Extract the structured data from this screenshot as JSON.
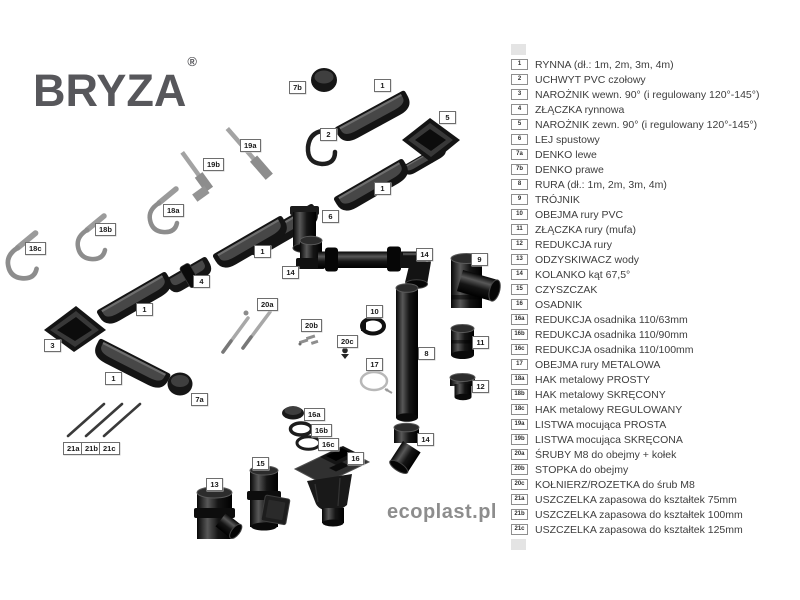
{
  "brand": {
    "name": "BRYZA",
    "registered_mark": "®"
  },
  "footer": {
    "website": "ecoplast.pl"
  },
  "colors": {
    "part_dark": "#141414",
    "metal_gray": "#9b9b9b",
    "logo_gray": "#57575b",
    "footer_gray": "#8d8d8d",
    "label_border": "#6e6e6e",
    "legend_text": "#3d3d3d"
  },
  "legend": {
    "items": [
      {
        "id": "1",
        "label": "RYNNA (dł.: 1m, 2m, 3m, 4m)"
      },
      {
        "id": "2",
        "label": "UCHWYT PVC czołowy"
      },
      {
        "id": "3",
        "label": "NAROŻNIK wewn. 90° (i regulowany 120°-145°)"
      },
      {
        "id": "4",
        "label": "ZŁĄCZKA rynnowa"
      },
      {
        "id": "5",
        "label": "NAROŻNIK zewn. 90° (i regulowany 120°-145°)"
      },
      {
        "id": "6",
        "label": "LEJ spustowy"
      },
      {
        "id": "7a",
        "label": "DENKO lewe"
      },
      {
        "id": "7b",
        "label": "DENKO prawe"
      },
      {
        "id": "8",
        "label": "RURA (dł.: 1m, 2m, 3m, 4m)"
      },
      {
        "id": "9",
        "label": "TRÓJNIK"
      },
      {
        "id": "10",
        "label": "OBEJMA rury PVC"
      },
      {
        "id": "11",
        "label": "ZŁĄCZKA rury (mufa)"
      },
      {
        "id": "12",
        "label": "REDUKCJA rury"
      },
      {
        "id": "13",
        "label": "ODZYSKIWACZ wody"
      },
      {
        "id": "14",
        "label": "KOLANKO kąt 67,5°"
      },
      {
        "id": "15",
        "label": "CZYSZCZAK"
      },
      {
        "id": "16",
        "label": "OSADNIK"
      },
      {
        "id": "16a",
        "label": "REDUKCJA osadnika 110/63mm"
      },
      {
        "id": "16b",
        "label": "REDUKCJA osadnika 110/90mm"
      },
      {
        "id": "16c",
        "label": "REDUKCJA osadnika 110/100mm"
      },
      {
        "id": "17",
        "label": "OBEJMA rury METALOWA"
      },
      {
        "id": "18a",
        "label": "HAK metalowy PROSTY"
      },
      {
        "id": "18b",
        "label": "HAK metalowy SKRĘCONY"
      },
      {
        "id": "18c",
        "label": "HAK metalowy REGULOWANY"
      },
      {
        "id": "19a",
        "label": "LISTWA mocująca PROSTA"
      },
      {
        "id": "19b",
        "label": "LISTWA mocująca SKRĘCONA"
      },
      {
        "id": "20a",
        "label": "ŚRUBY M8 do obejmy + kołek"
      },
      {
        "id": "20b",
        "label": "STOPKA do obejmy"
      },
      {
        "id": "20c",
        "label": "KOŁNIERZ/ROZETKA do śrub M8"
      },
      {
        "id": "21a",
        "label": "USZCZELKA zapasowa do kształtek 75mm"
      },
      {
        "id": "21b",
        "label": "USZCZELKA zapasowa do kształtek 100mm"
      },
      {
        "id": "21c",
        "label": "USZCZELKA zapasowa do kształtek 125mm"
      }
    ]
  },
  "diagram": {
    "part_labels": [
      {
        "id": "7b",
        "x": 289,
        "y": 81
      },
      {
        "id": "1",
        "x": 374,
        "y": 79
      },
      {
        "id": "5",
        "x": 439,
        "y": 111
      },
      {
        "id": "2",
        "x": 320,
        "y": 128
      },
      {
        "id": "19a",
        "x": 240,
        "y": 139
      },
      {
        "id": "19b",
        "x": 203,
        "y": 158
      },
      {
        "id": "1",
        "x": 374,
        "y": 182
      },
      {
        "id": "18a",
        "x": 163,
        "y": 204
      },
      {
        "id": "6",
        "x": 322,
        "y": 210
      },
      {
        "id": "18b",
        "x": 95,
        "y": 223
      },
      {
        "id": "18c",
        "x": 25,
        "y": 242
      },
      {
        "id": "1",
        "x": 254,
        "y": 245
      },
      {
        "id": "14",
        "x": 282,
        "y": 266
      },
      {
        "id": "14",
        "x": 416,
        "y": 248
      },
      {
        "id": "9",
        "x": 471,
        "y": 253
      },
      {
        "id": "4",
        "x": 193,
        "y": 275
      },
      {
        "id": "20a",
        "x": 257,
        "y": 298
      },
      {
        "id": "1",
        "x": 136,
        "y": 303
      },
      {
        "id": "10",
        "x": 366,
        "y": 305
      },
      {
        "id": "20b",
        "x": 301,
        "y": 319
      },
      {
        "id": "20c",
        "x": 337,
        "y": 335
      },
      {
        "id": "11",
        "x": 472,
        "y": 336
      },
      {
        "id": "3",
        "x": 44,
        "y": 339
      },
      {
        "id": "8",
        "x": 418,
        "y": 347
      },
      {
        "id": "17",
        "x": 366,
        "y": 358
      },
      {
        "id": "1",
        "x": 105,
        "y": 372
      },
      {
        "id": "12",
        "x": 472,
        "y": 380
      },
      {
        "id": "7a",
        "x": 191,
        "y": 393
      },
      {
        "id": "16a",
        "x": 304,
        "y": 408
      },
      {
        "id": "16b",
        "x": 311,
        "y": 424
      },
      {
        "id": "16c",
        "x": 318,
        "y": 438
      },
      {
        "id": "21a",
        "x": 63,
        "y": 442
      },
      {
        "id": "21b",
        "x": 81,
        "y": 442
      },
      {
        "id": "21c",
        "x": 99,
        "y": 442
      },
      {
        "id": "16",
        "x": 347,
        "y": 452
      },
      {
        "id": "15",
        "x": 252,
        "y": 457
      },
      {
        "id": "14",
        "x": 417,
        "y": 433
      },
      {
        "id": "13",
        "x": 206,
        "y": 478
      }
    ]
  }
}
